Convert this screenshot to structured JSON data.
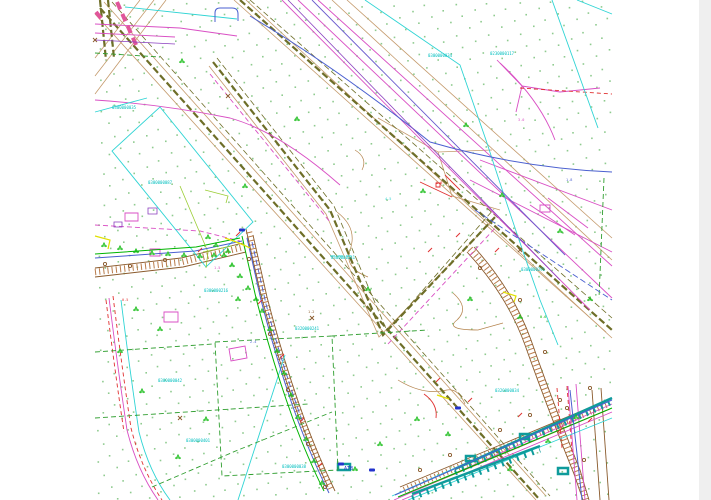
{
  "page": {
    "background": "#ffffff",
    "edge_color": "#efefef",
    "width": 711,
    "height": 500
  },
  "palette": {
    "olive_boundary": "#6e6e28",
    "tan_utility": "#c49a6c",
    "road_brown": "#8a5a2c",
    "hatch_brown": "#b97b4a",
    "magenta_utility": "#d94fc4",
    "red_utility": "#e03030",
    "pink_road": "#e0559a",
    "cyan_parcel": "#2fd4d4",
    "teal_platform": "#0f9b9b",
    "green_parcel": "#2f9e2f",
    "green_utility": "#00b400",
    "lime": "#9acd32",
    "blue_utility": "#4a5fd0",
    "violet": "#6a5acd",
    "purple": "#8a3fbf",
    "yellow": "#e0e000",
    "vegetation_dot": "#8fcb8f",
    "tree_green": "#22c022",
    "label_cyan": "#00bfbf"
  },
  "map": {
    "dots": {
      "color": "#8fcb8f",
      "size": 1.6,
      "spacing": 14,
      "angle_deg": -28,
      "bounds": {
        "x0": 96,
        "y0": 0,
        "x1": 610,
        "y1": 500
      }
    },
    "labels": [
      {
        "t": "0300000035",
        "x": 112,
        "y": 109,
        "c": "#00bfbf",
        "s": 4
      },
      {
        "t": "0300000087",
        "x": 148,
        "y": 184,
        "c": "#00bfbf",
        "s": 4
      },
      {
        "t": "0300000216",
        "x": 204,
        "y": 292,
        "c": "#00bfbf",
        "s": 4
      },
      {
        "t": "0300000241",
        "x": 331,
        "y": 259,
        "c": "#00bfbf",
        "s": 4
      },
      {
        "t": "0320000241",
        "x": 295,
        "y": 330,
        "c": "#00bfbf",
        "s": 4
      },
      {
        "t": "0300000038",
        "x": 282,
        "y": 468,
        "c": "#00bfbf",
        "s": 4
      },
      {
        "t": "0300000042",
        "x": 158,
        "y": 382,
        "c": "#00bfbf",
        "s": 4
      },
      {
        "t": "0300000401",
        "x": 186,
        "y": 442,
        "c": "#00bfbf",
        "s": 4
      },
      {
        "t": "0300000034",
        "x": 428,
        "y": 57,
        "c": "#00bfbf",
        "s": 4
      },
      {
        "t": "0230000117",
        "x": 490,
        "y": 55,
        "c": "#00bfbf",
        "s": 4
      },
      {
        "t": "0320000034",
        "x": 495,
        "y": 392,
        "c": "#00bfbf",
        "s": 4
      },
      {
        "t": "0300000291",
        "x": 521,
        "y": 271,
        "c": "#00bfbf",
        "s": 4
      },
      {
        "t": "ATB",
        "x": 344,
        "y": 470,
        "c": "#2233cc",
        "s": 5
      },
      {
        "t": "1.5",
        "x": 214,
        "y": 269,
        "c": "#d94fc4",
        "s": 3.5
      },
      {
        "t": "2.4",
        "x": 250,
        "y": 343,
        "c": "#4a5fd0",
        "s": 3.5
      },
      {
        "t": "0.8",
        "x": 436,
        "y": 184,
        "c": "#e03030",
        "s": 3.5
      },
      {
        "t": "1.2",
        "x": 308,
        "y": 313,
        "c": "#8a5a2c",
        "s": 3.5
      },
      {
        "t": "3.0",
        "x": 518,
        "y": 121,
        "c": "#d94fc4",
        "s": 3.5
      },
      {
        "t": "1.8",
        "x": 566,
        "y": 181,
        "c": "#4a5fd0",
        "s": 3.5
      },
      {
        "t": "0.5",
        "x": 122,
        "y": 301,
        "c": "#e03030",
        "s": 3.5
      },
      {
        "t": "2.2",
        "x": 476,
        "y": 431,
        "c": "#8a5a2c",
        "s": 3.5
      },
      {
        "t": "4.5",
        "x": 385,
        "y": 200,
        "c": "#2fd4d4",
        "s": 3.5
      },
      {
        "t": "0.6",
        "x": 540,
        "y": 318,
        "c": "#00b400",
        "s": 3.5
      }
    ],
    "layers": [
      {
        "name": "contour-lines",
        "color": "#b5854f",
        "width": 0.7,
        "dash": "",
        "paths": [
          "M337,212 Q358,228 350,250 Q344,268 368,277",
          "M453,293 Q470,308 457,320 Q444,330 478,330 L503,323",
          "M398,380 Q424,396 447,390 Q458,388 465,404",
          "M355,150 Q368,158 362,170"
        ]
      },
      {
        "name": "tan-utility-lines",
        "color": "#c49a6c",
        "width": 0.8,
        "dash": "",
        "paths": [
          "M95,14 L536,500",
          "M104,2 L546,496",
          "M246,0 L612,338",
          "M234,0 L606,332",
          "M209,66 L326,214 L379,337 L494,219",
          "M140,0 L95,58",
          "M154,0 L95,76",
          "M166,0 L95,94",
          "M332,0 L612,260",
          "M347,0 L612,238",
          "M378,118 L438,152 L492,150",
          "M438,152 L452,196 L500,210"
        ]
      },
      {
        "name": "olive-boundary-dashed",
        "color": "#6e6e28",
        "width": 2.2,
        "dash": "7 3",
        "paths": [
          "M100,8 L540,500",
          "M240,0 L612,330",
          "M213,62 L330,210 L383,335 L497,215",
          "M100,0 L106,60",
          "M108,0 L114,58"
        ]
      },
      {
        "name": "olive-boundary-thin",
        "color": "#6e6e28",
        "width": 0.8,
        "dash": "6 3",
        "paths": [
          "M112,2 L550,496",
          "M250,0 L612,318",
          "M217,58 L334,206 L387,331 L494,209"
        ]
      },
      {
        "name": "road-hatching",
        "color": "#b97b4a",
        "width": 6.5,
        "dash": "1 3.2",
        "paths": [
          "M249,232 L263,294 Q280,360 300,415 Q315,455 331,489",
          "M95,272 L182,262 L244,247",
          "M470,249 Q510,292 528,342 Q550,405 577,472 L586,500",
          "M404,490 L608,404"
        ]
      },
      {
        "name": "road-edges",
        "color": "#8a5a2c",
        "width": 0.9,
        "dash": "",
        "paths": [
          "M246,229 L260,291 Q277,357 297,412 Q312,452 328,487",
          "M253,235 L267,297 Q284,363 304,418 Q319,458 335,491",
          "M95,268 L181,258 L243,243",
          "M95,277 L183,267 L246,252",
          "M467,252 Q507,295 525,345 Q547,407 574,474 L583,500",
          "M474,247 Q513,290 531,340 Q553,403 580,470 L589,500",
          "M400,487 L610,399",
          "M407,494 L610,409",
          "M592,390 L600,500",
          "M601,388 L609,500"
        ]
      },
      {
        "name": "magenta-utilities",
        "color": "#d94fc4",
        "width": 0.9,
        "dash": "",
        "paths": [
          "M95,24 L180,28 L237,36",
          "M95,33 L175,37",
          "M95,100 Q160,104 230,118 Q280,132 340,185",
          "M282,0 L590,310",
          "M298,0 L612,298",
          "M318,0 L612,266",
          "M394,500 L612,404",
          "M402,500 L612,412",
          "M568,386 L577,500",
          "M576,384 L585,500",
          "M109,298 Q118,370 127,430 Q137,470 158,500",
          "M497,60 L522,86 L516,112",
          "M522,86 L560,92 L600,88",
          "M500,63 Q540,100 555,140",
          "M530,205 L575,235",
          "M548,198 L588,228",
          "M470,180 L612,252",
          "M480,160 L612,210",
          "M125,213 h13 v8 h-13 z",
          "M150,249 h10 v7 h-10 z",
          "M164,312 h14 v10 h-14 z",
          "M229,349 l16,-3 2,12 -16,3 z",
          "M540,205 h10 v7 h-10 z"
        ]
      },
      {
        "name": "magenta-dashed",
        "color": "#d94fc4",
        "width": 0.9,
        "dash": "5 3",
        "paths": [
          "M95,225 L200,231 L240,241",
          "M210,74 L330,222",
          "M388,344 L497,226"
        ]
      },
      {
        "name": "red-utilities",
        "color": "#e03030",
        "width": 0.9,
        "dash": "",
        "paths": [
          "M424,394 Q438,404 436,418",
          "M420,182 L452,197",
          "M445,175 L460,190",
          "M436,183 h4 v4 h-4 z"
        ]
      },
      {
        "name": "red-dashed",
        "color": "#e03030",
        "width": 0.9,
        "dash": "4 3",
        "paths": [
          "M113,296 Q122,368 131,428 Q141,468 162,500",
          "M106,300 Q115,372 124,432",
          "M557,388 L562,448",
          "M567,386 L572,452",
          "M520,88 L612,94"
        ]
      },
      {
        "name": "pink-road-thick",
        "color": "#e0559a",
        "width": 4,
        "dash": "8 5",
        "paths": [
          "M117,2 L137,47",
          "M96,12 L104,22"
        ]
      },
      {
        "name": "cyan-parcels",
        "color": "#2fd4d4",
        "width": 0.9,
        "dash": "",
        "paths": [
          "M160,107 L253,222 L206,267 L112,151 Z",
          "M147,98 L95,112",
          "M125,7 L237,19",
          "M365,0 L460,65 L487,143 Q515,230 540,300 L558,345",
          "M552,0 L598,128",
          "M577,0 L612,14",
          "M285,355 L238,500",
          "M392,496 L612,398",
          "M408,500 L612,418",
          "M330,256 l5,0 m3,0 l5,0 m3,0 l5,0",
          "M121,300 Q130,372 139,432 Q149,472 170,500"
        ]
      },
      {
        "name": "teal-platforms",
        "color": "#0f9b9b",
        "width": 2.5,
        "dash": "",
        "paths": [
          "M455,469 L612,398",
          "M412,494 L540,446",
          "M466,456 h9 v5 h-9 z",
          "M520,434 h9 v5 h-9 z",
          "M558,468 h10 v6 h-10 z",
          "M338,464 h12 v6 h-12 z"
        ]
      },
      {
        "name": "teal-platform-teeth",
        "color": "#0f9b9b",
        "width": 5,
        "dash": "2 6",
        "paths": [
          "M455,473 L612,402",
          "M412,498 L540,450"
        ]
      },
      {
        "name": "green-parcel-dashed",
        "color": "#2f9e2f",
        "width": 0.9,
        "dash": "5 3",
        "paths": [
          "M215,342 L332,336 L338,470 L222,476 Z",
          "M95,352 L213,344",
          "M95,418 L308,404",
          "M152,487 L238,450 L332,412",
          "M332,336 L428,330",
          "M604,178 L599,298",
          "M95,53 L160,57"
        ]
      },
      {
        "name": "green-utilities",
        "color": "#00b400",
        "width": 1,
        "dash": "",
        "paths": [
          "M398,497 L612,408",
          "M242,236 L256,298 Q273,364 293,419 Q308,459 324,491",
          "M95,254 L196,247 L240,238"
        ]
      },
      {
        "name": "lime-lines",
        "color": "#9acd32",
        "width": 0.8,
        "dash": "",
        "paths": [
          "M180,186 L208,252 L206,268",
          "M205,190 L228,196 L226,203",
          "M203,252 L232,246"
        ]
      },
      {
        "name": "blue-utilities",
        "color": "#4a5fd0",
        "width": 1,
        "dash": "",
        "paths": [
          "M215,22 L215,13 Q215,8 220,8 L232,8 Q238,8 238,14 L238,21",
          "M250,16 Q340,70 430,142 Q520,168 612,172",
          "M247,238 L261,300 Q278,366 298,421 Q313,461 329,493",
          "M95,258 L195,251 L242,241",
          "M395,495 L612,400",
          "M570,390 L582,500"
        ]
      },
      {
        "name": "blue-dashed",
        "color": "#4a5fd0",
        "width": 0.9,
        "dash": "6 3",
        "paths": [
          "M252,242 L266,304 Q283,368 303,423",
          "M475,210 L612,300"
        ]
      },
      {
        "name": "violet-line",
        "color": "#6a5acd",
        "width": 0.9,
        "dash": "",
        "paths": [
          "M312,0 L565,255"
        ]
      },
      {
        "name": "purple-lines",
        "color": "#8a3fbf",
        "width": 0.8,
        "dash": "",
        "paths": [
          "M288,0 L560,280",
          "M95,40 L175,44",
          "M148,208 h9 v6 h-9 z",
          "M114,222 h8 v5 h-8 z"
        ]
      },
      {
        "name": "yellow-marks",
        "color": "#e0e000",
        "width": 1.2,
        "dash": "",
        "paths": [
          "M95,236 L110,240 L108,249",
          "M225,238 Q240,243 250,248",
          "M503,292 L516,296 L514,302",
          "M437,395 L449,399"
        ]
      }
    ],
    "symbols": {
      "trees": {
        "color": "#22c022",
        "pts": [
          [
            104,
            246
          ],
          [
            120,
            249
          ],
          [
            136,
            252
          ],
          [
            152,
            254
          ],
          [
            168,
            255
          ],
          [
            184,
            256
          ],
          [
            200,
            257
          ],
          [
            214,
            256
          ],
          [
            228,
            252
          ],
          [
            208,
            238
          ],
          [
            216,
            246
          ],
          [
            224,
            256
          ],
          [
            232,
            266
          ],
          [
            240,
            277
          ],
          [
            248,
            289
          ],
          [
            256,
            300
          ],
          [
            262,
            312
          ],
          [
            270,
            330
          ],
          [
            277,
            352
          ],
          [
            284,
            374
          ],
          [
            291,
            396
          ],
          [
            298,
            418
          ],
          [
            306,
            440
          ],
          [
            314,
            462
          ],
          [
            322,
            484
          ],
          [
            245,
            187
          ],
          [
            297,
            120
          ],
          [
            182,
            62
          ],
          [
            423,
            192
          ],
          [
            466,
            126
          ],
          [
            502,
            196
          ],
          [
            560,
            232
          ],
          [
            368,
            290
          ],
          [
            417,
            420
          ],
          [
            380,
            445
          ],
          [
            355,
            470
          ],
          [
            448,
            435
          ],
          [
            470,
            300
          ],
          [
            520,
            318
          ],
          [
            590,
            300
          ],
          [
            120,
            352
          ],
          [
            142,
            392
          ],
          [
            178,
            458
          ],
          [
            206,
            420
          ],
          [
            238,
            300
          ],
          [
            576,
            418
          ],
          [
            548,
            442
          ],
          [
            510,
            470
          ],
          [
            136,
            310
          ],
          [
            160,
            330
          ]
        ]
      },
      "poles": {
        "color": "#8a5a2c",
        "pts": [
          [
            249,
            259
          ],
          [
            270,
            334
          ],
          [
            288,
            390
          ],
          [
            308,
            444
          ],
          [
            325,
            487
          ],
          [
            165,
            260
          ],
          [
            130,
            266
          ],
          [
            105,
            264
          ],
          [
            480,
            268
          ],
          [
            520,
            300
          ],
          [
            545,
            352
          ],
          [
            567,
            408
          ],
          [
            584,
            460
          ],
          [
            420,
            470
          ],
          [
            450,
            455
          ],
          [
            500,
            430
          ],
          [
            530,
            415
          ],
          [
            560,
            400
          ],
          [
            590,
            388
          ]
        ]
      },
      "ticks": {
        "color": "#e03030",
        "pts": [
          [
            238,
            234
          ],
          [
            260,
            302
          ],
          [
            282,
            356
          ],
          [
            302,
            420
          ],
          [
            320,
            465
          ],
          [
            200,
            250
          ],
          [
            438,
            380
          ],
          [
            470,
            400
          ],
          [
            520,
            415
          ],
          [
            560,
            430
          ],
          [
            590,
            420
          ],
          [
            430,
            250
          ],
          [
            458,
            235
          ],
          [
            497,
            250
          ]
        ]
      },
      "chips": {
        "color": "#2233cc",
        "pts": [
          [
            242,
            230
          ],
          [
            458,
            408
          ],
          [
            341,
            464
          ],
          [
            372,
            470
          ]
        ]
      },
      "xmarks": {
        "color": "#8a5a2c",
        "pts": [
          [
            95,
            40
          ],
          [
            228,
            96
          ],
          [
            312,
            318
          ],
          [
            180,
            418
          ],
          [
            520,
            250
          ]
        ]
      }
    }
  }
}
